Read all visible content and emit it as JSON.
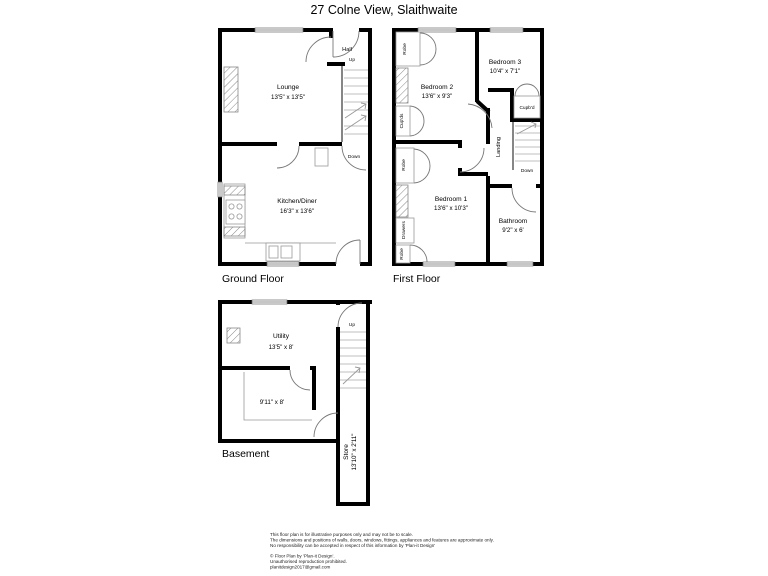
{
  "title": "27 Colne View, Slaithwaite",
  "ground_floor": {
    "label": "Ground Floor",
    "lounge_name": "Lounge",
    "lounge_dims": "13'5\" x 13'5\"",
    "kitchen_name": "Kitchen/Diner",
    "kitchen_dims": "16'3\" x 13'6\"",
    "hall": "Hall",
    "up": "Up",
    "down": "Down"
  },
  "first_floor": {
    "label": "First Floor",
    "bedroom1_name": "Bedroom 1",
    "bedroom1_dims": "13'6\" x 10'3\"",
    "bedroom2_name": "Bedroom 2",
    "bedroom2_dims": "13'6\" x 9'3\"",
    "bedroom3_name": "Bedroom 3",
    "bedroom3_dims": "10'4\" x 7'1\"",
    "bathroom_name": "Bathroom",
    "bathroom_dims": "9'2\" x 6'",
    "landing": "Landing",
    "robe": "Robe",
    "cupds": "Cup'ds",
    "cupbd": "Cupb'd",
    "drawers": "Drawers",
    "down": "Down"
  },
  "basement": {
    "label": "Basement",
    "utility_name": "Utility",
    "utility_dims": "13'5\" x 8'",
    "room_dims": "9'11\" x 8'",
    "store_name": "Store",
    "store_dims": "13'10\" x 2'11\"",
    "up": "Up"
  },
  "footer": {
    "disclaimer_line1": "This floor plan is for illustrative purposes only and may not be to scale.",
    "disclaimer_line2": "The dimensions and positions of walls, doors, windows, fittings, appliances and features are approximate only.",
    "disclaimer_line3": "No responsibility can be accepted in respect of this information by 'Plan-it Design'",
    "copyright_line1": "© Floor Plan by 'Plan-it Design'.",
    "copyright_line2": "Unauthorised reproduction prohibited.",
    "copyright_line3": "planitdesign2017@gmail.com"
  },
  "colors": {
    "wall": "#000000",
    "thin_line": "#999999",
    "text": "#000000",
    "background": "#ffffff"
  }
}
